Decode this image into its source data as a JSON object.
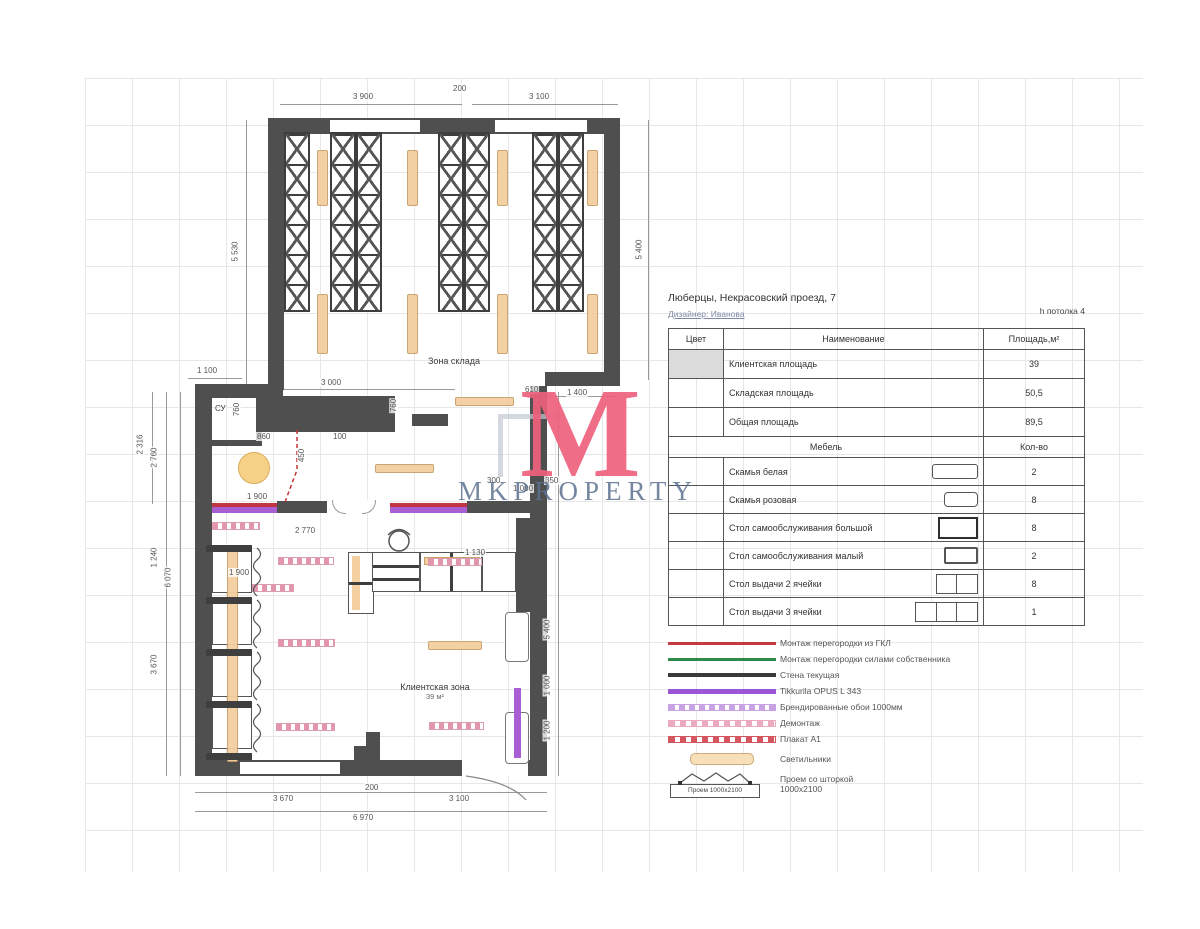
{
  "watermark": {
    "monogram": "M",
    "brand": "MKPROPERTY"
  },
  "header": {
    "address": "Люберцы, Некрасовский проезд, 7",
    "designer": "Дизайнер: Иванова",
    "ceiling": "h потолка 4"
  },
  "area_table": {
    "col_color": "Цвет",
    "col_name": "Наименование",
    "col_area": "Площадь,м²",
    "rows": [
      {
        "name": "Клиентская площадь",
        "value": "39"
      },
      {
        "name": "Складская площадь",
        "value": "50,5"
      },
      {
        "name": "Общая площадь",
        "value": "89,5"
      }
    ],
    "furniture_label": "Мебель",
    "count_label": "Кол-во",
    "furniture": [
      {
        "name": "Скамья белая",
        "count": "2"
      },
      {
        "name": "Скамья розовая",
        "count": "8"
      },
      {
        "name": "Стол самообслуживания большой",
        "count": "8"
      },
      {
        "name": "Стол самообслуживания малый",
        "count": "2"
      },
      {
        "name": "Стол выдачи 2 ячейки",
        "count": "8"
      },
      {
        "name": "Стол выдачи 3 ячейки",
        "count": "1"
      }
    ]
  },
  "legend": {
    "items": [
      {
        "label": "Монтаж перегородки из ГКЛ",
        "color": "#c43a42",
        "style": "solid"
      },
      {
        "label": "Монтаж перегородки силами собственника",
        "color": "#2e8b4a",
        "style": "solid"
      },
      {
        "label": "Стена текущая",
        "color": "#3a3a3a",
        "style": "solid"
      },
      {
        "label": "Tikkurila OPUS L 343",
        "color": "#9c55d4",
        "style": "solid"
      },
      {
        "label": "Брендированные обои 1000мм",
        "color": "#c7a3e3",
        "style": "dashed"
      },
      {
        "label": "Демонтаж",
        "color": "#ecaabf",
        "style": "dashed"
      },
      {
        "label": "Плакат А1",
        "color": "#d5565e",
        "style": "dashed"
      },
      {
        "label": "Светильники",
        "color": "#f7dfb8",
        "style": "bar"
      },
      {
        "label": "Проем со шторкой\n1000х2100",
        "style": "opening",
        "box_text": "Проем 1000х2100"
      }
    ]
  },
  "plan": {
    "labels": {
      "storage": "Зона склада",
      "wc": "СУ",
      "client": "Клиентская зона",
      "client_area": "39 м²"
    },
    "dims": [
      {
        "t": "3 900"
      },
      {
        "t": "200"
      },
      {
        "t": "3 100"
      },
      {
        "t": "5 530"
      },
      {
        "t": "5 400"
      },
      {
        "t": "1 100"
      },
      {
        "t": "3 000"
      },
      {
        "t": "610"
      },
      {
        "t": "1 400"
      },
      {
        "t": "760"
      },
      {
        "t": "860"
      },
      {
        "t": "100"
      },
      {
        "t": "760"
      },
      {
        "t": "450"
      },
      {
        "t": "1 900"
      },
      {
        "t": "300"
      },
      {
        "t": "1 000"
      },
      {
        "t": "350"
      },
      {
        "t": "2 770"
      },
      {
        "t": "1 900"
      },
      {
        "t": "1 130"
      },
      {
        "t": "2 316"
      },
      {
        "t": "2 760"
      },
      {
        "t": "1 240"
      },
      {
        "t": "3 670"
      },
      {
        "t": "6 070"
      },
      {
        "t": "5 400"
      },
      {
        "t": "1 000"
      },
      {
        "t": "1 200"
      },
      {
        "t": "3 670"
      },
      {
        "t": "200"
      },
      {
        "t": "3 100"
      },
      {
        "t": "6 970"
      }
    ]
  }
}
